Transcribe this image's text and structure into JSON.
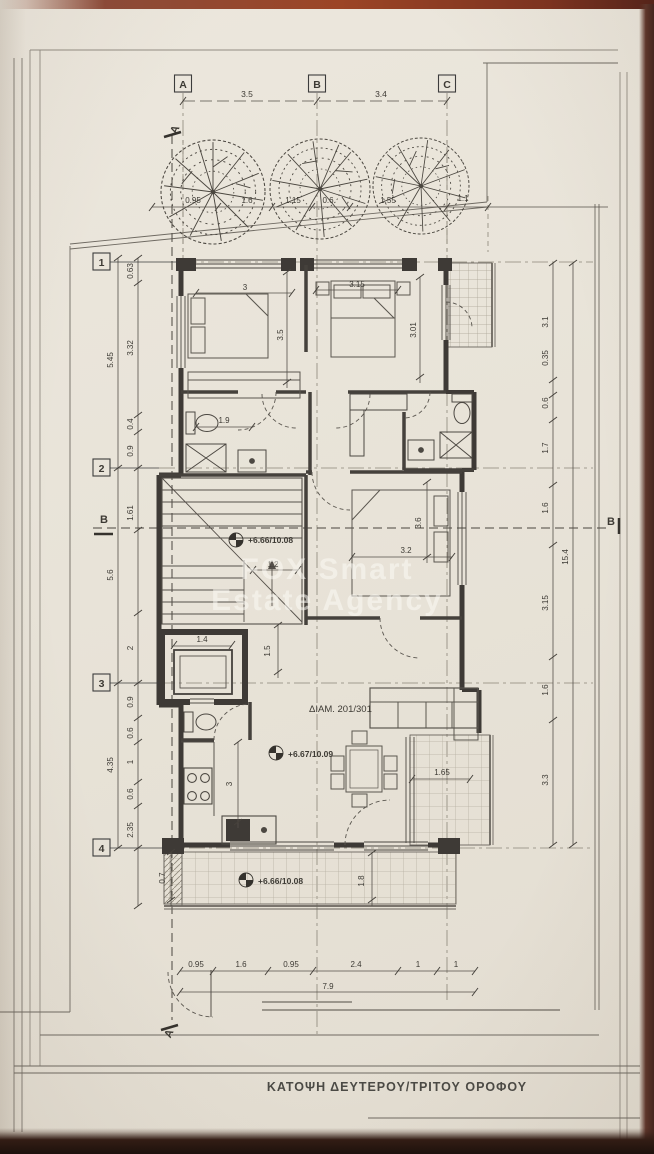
{
  "title": {
    "caption": "ΚΑΤΟΨΗ ΔΕΥΤΕΡΟΥ/ΤΡΙΤΟΥ ΟΡΟΦΟΥ"
  },
  "watermark": {
    "line1": "FOX Smart",
    "line2": "Estate Agency"
  },
  "unit_label": "ΔΙΑΜ. 201/301",
  "levels": {
    "stair": "+6.66/10.08",
    "living": "+6.67/10.09",
    "balcony": "+6.66/10.08"
  },
  "grid": {
    "col_a": "A",
    "col_b": "B",
    "col_c": "C",
    "row_1": "1",
    "row_2": "2",
    "row_3": "3",
    "row_4": "4",
    "section_a_top": "A",
    "section_a_bottom": "A",
    "section_b_left": "B",
    "section_b_right": "B"
  },
  "dims": {
    "top": {
      "ab": "3.5",
      "bc": "3.4"
    },
    "tree_band": {
      "d1": "0.95",
      "d2": "1.6",
      "d3": "1.15",
      "d4": "0.6",
      "d5": "1.55",
      "offset": "1.1"
    },
    "left_outer": {
      "s1": "5.45",
      "s2": "5.6",
      "s3": "4.35"
    },
    "left_inner": {
      "s1": "0.63",
      "s2": "3.32",
      "s3": "0.4",
      "s4": "0.9",
      "s5": "1.61",
      "s6": "2",
      "s7": "0.9",
      "s8": "0.6",
      "s9": "1",
      "s10": "0.6",
      "s11": "2.35"
    },
    "right_inner": {
      "s1": "3.1",
      "s2": "0.35",
      "s3": "0.6",
      "s4": "1.7",
      "s5": "1.6",
      "s6": "3.15",
      "s7": "1.6",
      "s8": "3.3"
    },
    "right_total": "15.4",
    "bottom": {
      "s1": "0.95",
      "s2": "1.6",
      "s3": "0.95",
      "s4": "2.4",
      "s5": "1",
      "s6": "1",
      "total": "7.9"
    },
    "rooms": {
      "bed1_w": "3",
      "bed1_d": "3.5",
      "bed2_w": "3.15",
      "bed2_d": "3.01",
      "bath1": "1.9",
      "stair_w": "1.2",
      "bed3_d": "3.6",
      "bed3_w": "3.2",
      "lift_w": "1.4",
      "hall_d": "1.5",
      "kitchen_d": "3",
      "balcony_r": "1.65",
      "balcony_b_d": "1.8",
      "planter_w": "0.7"
    }
  }
}
